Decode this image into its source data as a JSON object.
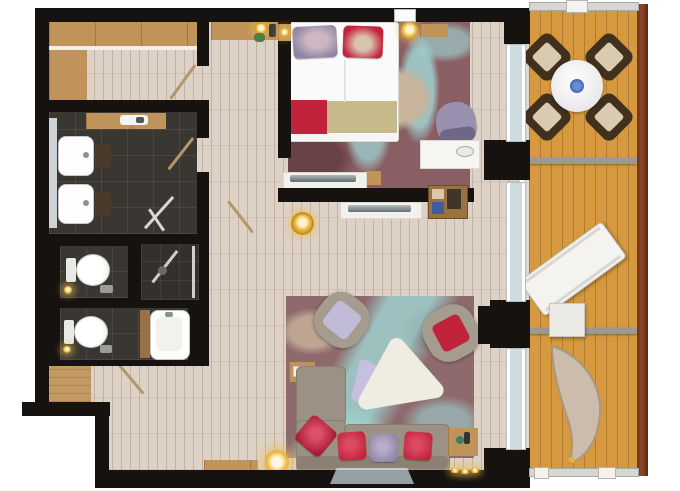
{
  "image": {
    "kind": "apartment-floor-plan-render",
    "view": "top-down",
    "background": "#ffffff"
  },
  "rooms": [
    {
      "name": "entry-hall",
      "floor": "light-wood-planks",
      "furniture": [
        "wardrobe-top",
        "wardrobe-left",
        "entry-door"
      ]
    },
    {
      "name": "corridor",
      "floor": "light-wood-planks",
      "furniture": [
        "console-shelf",
        "gold-tray",
        "plant",
        "phone"
      ]
    },
    {
      "name": "bathroom",
      "floor": "dark-tile",
      "furniture": [
        "mirror",
        "sink",
        "sink",
        "stool",
        "stool",
        "vanity-shelf",
        "shower-screen"
      ]
    },
    {
      "name": "wc-1",
      "floor": "dark-tile",
      "furniture": [
        "toilet"
      ]
    },
    {
      "name": "shower-room",
      "floor": "dark-tile",
      "furniture": [
        "glass-shower"
      ]
    },
    {
      "name": "wc-2",
      "floor": "dark-tile",
      "furniture": [
        "toilet",
        "bathtub",
        "tub-shelf"
      ]
    },
    {
      "name": "closet-niche",
      "floor": "wood",
      "furniture": []
    },
    {
      "name": "bedroom",
      "floor": "patterned-carpet",
      "furniture": [
        "double-bed",
        "pillows",
        "bed-runner",
        "nightstand",
        "bedside-lamp",
        "shelf-lamp",
        "wall-shelf",
        "armchair",
        "desk",
        "desk-lamp",
        "tv-console",
        "tv",
        "window"
      ]
    },
    {
      "name": "living-room",
      "floor": "light-wood-planks",
      "furniture": [
        "area-rug",
        "corner-sofa",
        "sofa-pillows",
        "armchair-lavender",
        "armchair-red",
        "coffee-table",
        "lavender-table",
        "side-table",
        "side-table",
        "minibar-shelf",
        "tv-console",
        "tv",
        "wall-tv",
        "floor-lamp",
        "media-lamp",
        "bench",
        "slippers"
      ]
    },
    {
      "name": "balcony",
      "floor": "orange-deck-planks",
      "furniture": [
        "dining-table",
        "fruit-bowl",
        "dining-chair",
        "dining-chair",
        "dining-chair",
        "dining-chair",
        "sun-lounger",
        "deck-table",
        "hanging-chair",
        "railing"
      ]
    }
  ],
  "counts": {
    "dining_chairs": 4,
    "sofa_pillows": 4,
    "bed_pillow_groups": 2,
    "toilets": 2,
    "sinks": 2,
    "door_swings": 4,
    "balcony_sections": 3,
    "gold_lamps": 4
  },
  "palette": {
    "wall": "#16120f",
    "plank": "#ddd2c5",
    "plankline": "rgba(125,104,86,.30)",
    "wood": "#c0935a",
    "woodd": "#9a7242",
    "tile": "#3a3733",
    "tile2": "#332f2c",
    "carpet": "#8a5f63",
    "teal": "#9fd2d1",
    "cbeige": "#c9b49c",
    "deck": "#d6993f",
    "rail": "#7b3a21",
    "brown": "#40301d",
    "cushion": "#d9cbb0",
    "sofa": "#9b9285",
    "sofad": "#877e70",
    "red": "#c2233c",
    "purple": "#8d83a5",
    "lav": "#c2bbd8",
    "gold": "#e8b23a",
    "off": "#f2f0ea",
    "glass": "#cfdcdf",
    "gray": "#97a0a4"
  }
}
